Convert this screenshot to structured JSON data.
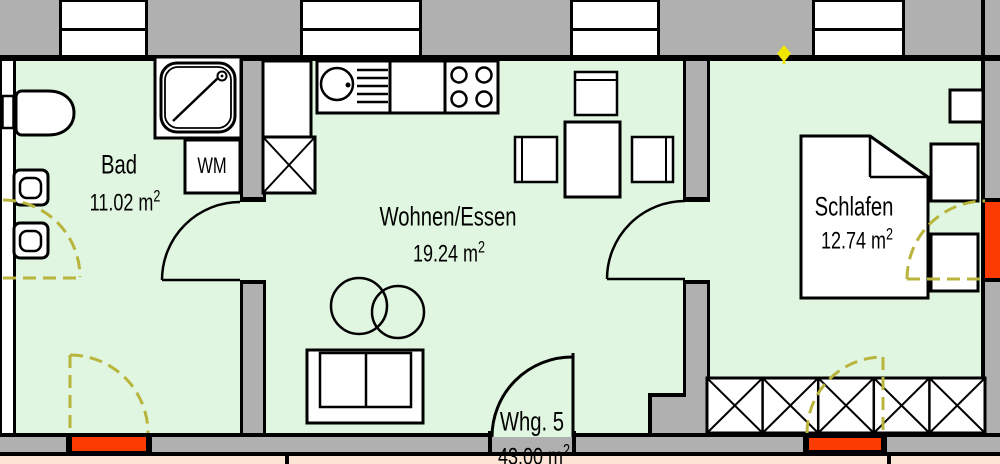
{
  "plan": {
    "unit": {
      "name": "Whg. 5",
      "area": "43.00 m",
      "exp": "2"
    },
    "rooms": [
      {
        "id": "bad",
        "name": "Bad",
        "area": "11.02 m",
        "exp": "2"
      },
      {
        "id": "wohnen",
        "name": "Wohnen/Essen",
        "area": "19.24 m",
        "exp": "2"
      },
      {
        "id": "schlafen",
        "name": "Schlafen",
        "area": "12.74 m",
        "exp": "2"
      }
    ],
    "appliances": {
      "washing_machine": "WM"
    },
    "colors": {
      "floor": "#E0F6E0",
      "wall_gray": "#B0B0B0",
      "door_marker_orange": "#FA3C00",
      "dashed_door_yellow": "#B9B43C",
      "marker_diamond_yellow": "#F0E600",
      "adjacent_unit_strip": "#FCE5D5",
      "line_black": "#000000"
    }
  }
}
